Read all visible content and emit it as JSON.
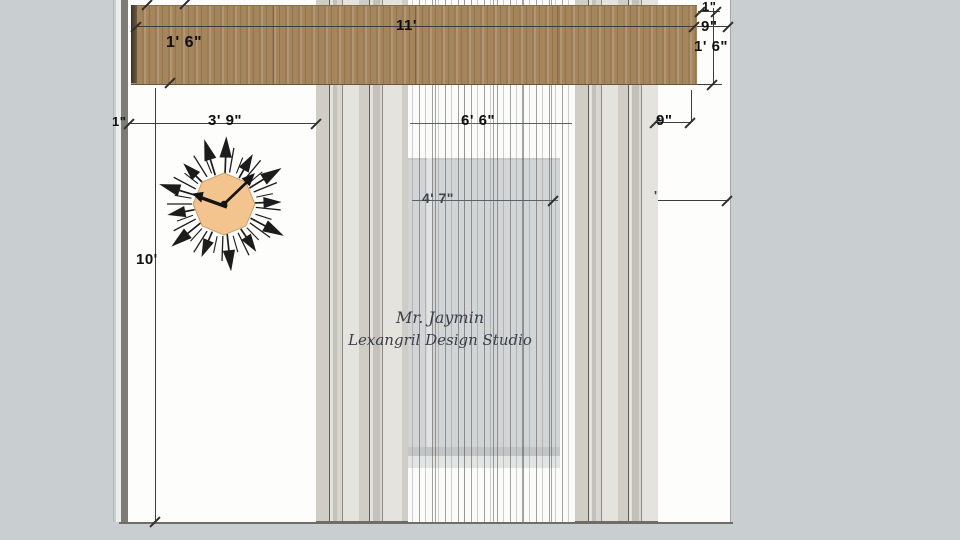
{
  "scene": {
    "type": "interior-elevation-drawing",
    "watermark": {
      "line1": "Mr. Jaymin",
      "line2": "Lexangril Design Studio"
    }
  },
  "dimensions": {
    "beam_width": "11'",
    "beam_thickness": "1' 6\"",
    "gap_top_right": "1\"",
    "offset_top_right": "9\"",
    "beam_height_right": "1' 6\"",
    "gap_left": "1\"",
    "clock_offset": "3' 9\"",
    "window_width": "6' 6\"",
    "offset_right": "9\"",
    "window_height": "4' 7\"",
    "partial_mark": "'",
    "wall_height": "10'"
  },
  "colors": {
    "background": "#c9ced1",
    "wall": "#fdfdfc",
    "beam_wood": "#a5855c",
    "drape": "#dbd8d0",
    "sheer": "#f6f6f4",
    "window_glass": "#abb0b4",
    "clock_face": "#f3c48d",
    "clock_rays": "#1c1c1c",
    "dimension_text": "#0f0f0f"
  }
}
